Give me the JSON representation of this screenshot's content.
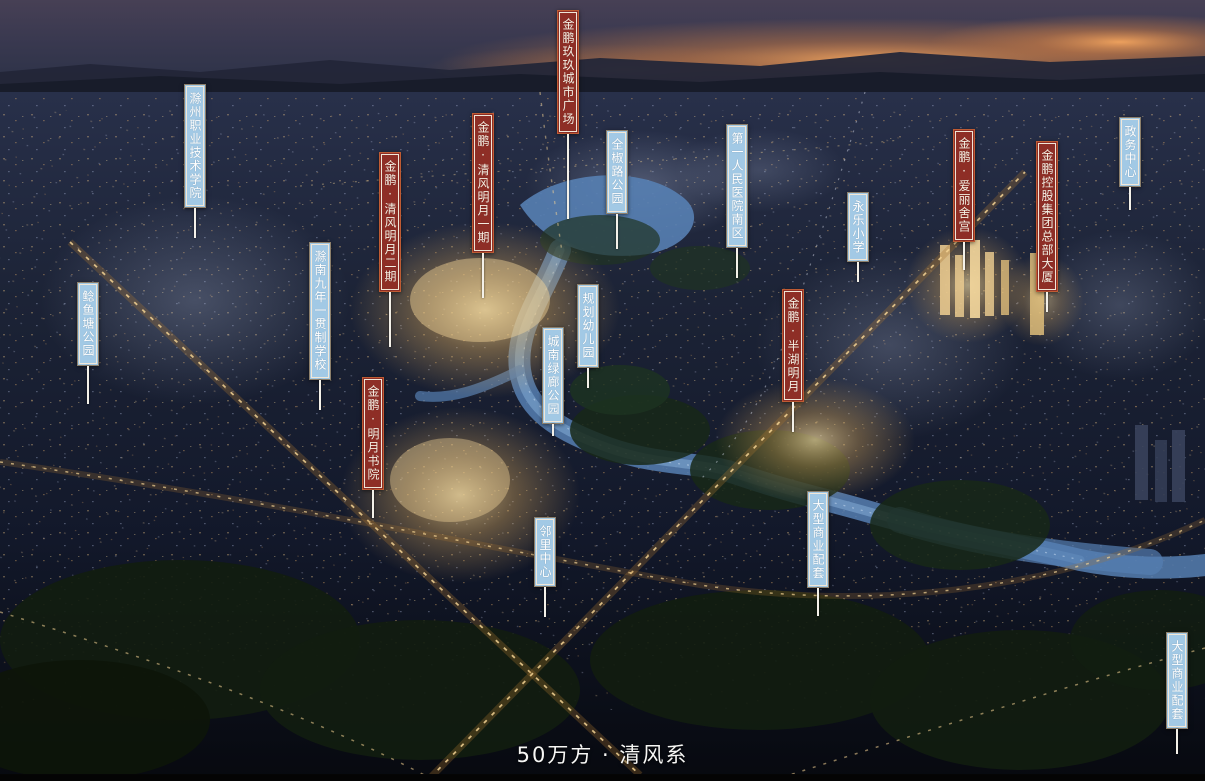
{
  "tagline": {
    "text": "50万方 · 清风系"
  },
  "colors": {
    "project_flag": "#8e2e26",
    "project_flag_outer_border": "#bf5b33",
    "amenity_flag": "#a2c9e5",
    "amenity_flag_outer_border": "#8c7f6b",
    "flag_inner_border": "#f0e7d8",
    "flag_text": "#f6efe3",
    "leader_line": "#f4f1e9",
    "sunset_glow": "#f0a055",
    "water": "#567fb2",
    "lit_buildings_gold": "#f0cc80"
  },
  "labels": [
    {
      "name": "jinpeng-jiujiu-city-plaza",
      "text": "金鹏玖玖城市广场",
      "category": "project",
      "x": 557,
      "y": 10,
      "line_length": 85
    },
    {
      "name": "chuzhou-vocational-technical-college",
      "text": "滁州职业技术学院",
      "category": "amenity",
      "x": 184,
      "y": 84,
      "line_length": 30
    },
    {
      "name": "jinpeng-qingfeng-mingyue-phase-2",
      "text": "金鹏·清风明月二期",
      "category": "project",
      "x": 379,
      "y": 152,
      "line_length": 55
    },
    {
      "name": "jinpeng-qingfeng-mingyue-phase-1",
      "text": "金鹏·清风明月一期",
      "category": "project",
      "x": 472,
      "y": 113,
      "line_length": 45
    },
    {
      "name": "quanjiao-road-park",
      "text": "全椒路公园",
      "category": "amenity",
      "x": 606,
      "y": 130,
      "line_length": 35
    },
    {
      "name": "first-peoples-hospital-south-district",
      "text": "第一人民医院南区",
      "category": "amenity",
      "x": 726,
      "y": 124,
      "line_length": 30
    },
    {
      "name": "yongle-primary-school",
      "text": "永乐小学",
      "category": "amenity",
      "x": 847,
      "y": 192,
      "line_length": 20
    },
    {
      "name": "government-affairs-center",
      "text": "政务中心",
      "category": "amenity",
      "x": 1119,
      "y": 117,
      "line_length": 23
    },
    {
      "name": "jinpeng-elysee-palace",
      "text": "金鹏·爱丽舍宫",
      "category": "project",
      "x": 953,
      "y": 129,
      "line_length": 28
    },
    {
      "name": "jinpeng-holdings-group-headquarters",
      "text": "金鹏控股集团总部大厦",
      "category": "project",
      "x": 1036,
      "y": 141,
      "line_length": 20
    },
    {
      "name": "nianyutang-park",
      "text": "鲶鱼塘公园",
      "category": "amenity",
      "x": 77,
      "y": 282,
      "line_length": 38
    },
    {
      "name": "chunan-nine-year-school",
      "text": "滁南九年一贯制学校",
      "category": "amenity",
      "x": 309,
      "y": 242,
      "line_length": 30
    },
    {
      "name": "planned-kindergarten",
      "text": "规划幼儿园",
      "category": "amenity",
      "x": 577,
      "y": 284,
      "line_length": 20
    },
    {
      "name": "chengnan-green-corridor-park",
      "text": "城南绿廊公园",
      "category": "amenity",
      "x": 542,
      "y": 327,
      "line_length": 12
    },
    {
      "name": "jinpeng-banhu-mingyue",
      "text": "金鹏·半湖明月",
      "category": "project",
      "x": 782,
      "y": 289,
      "line_length": 30
    },
    {
      "name": "jinpeng-mingyue-academy",
      "text": "金鹏·明月书院",
      "category": "project",
      "x": 362,
      "y": 377,
      "line_length": 28
    },
    {
      "name": "neighborhood-center",
      "text": "邻里中心",
      "category": "amenity",
      "x": 534,
      "y": 517,
      "line_length": 30
    },
    {
      "name": "large-commercial-facilities-central",
      "text": "大型商业配套",
      "category": "amenity",
      "x": 807,
      "y": 491,
      "line_length": 28
    },
    {
      "name": "large-commercial-facilities-southeast",
      "text": "大型商业配套",
      "category": "amenity",
      "x": 1166,
      "y": 632,
      "line_length": 25
    }
  ]
}
